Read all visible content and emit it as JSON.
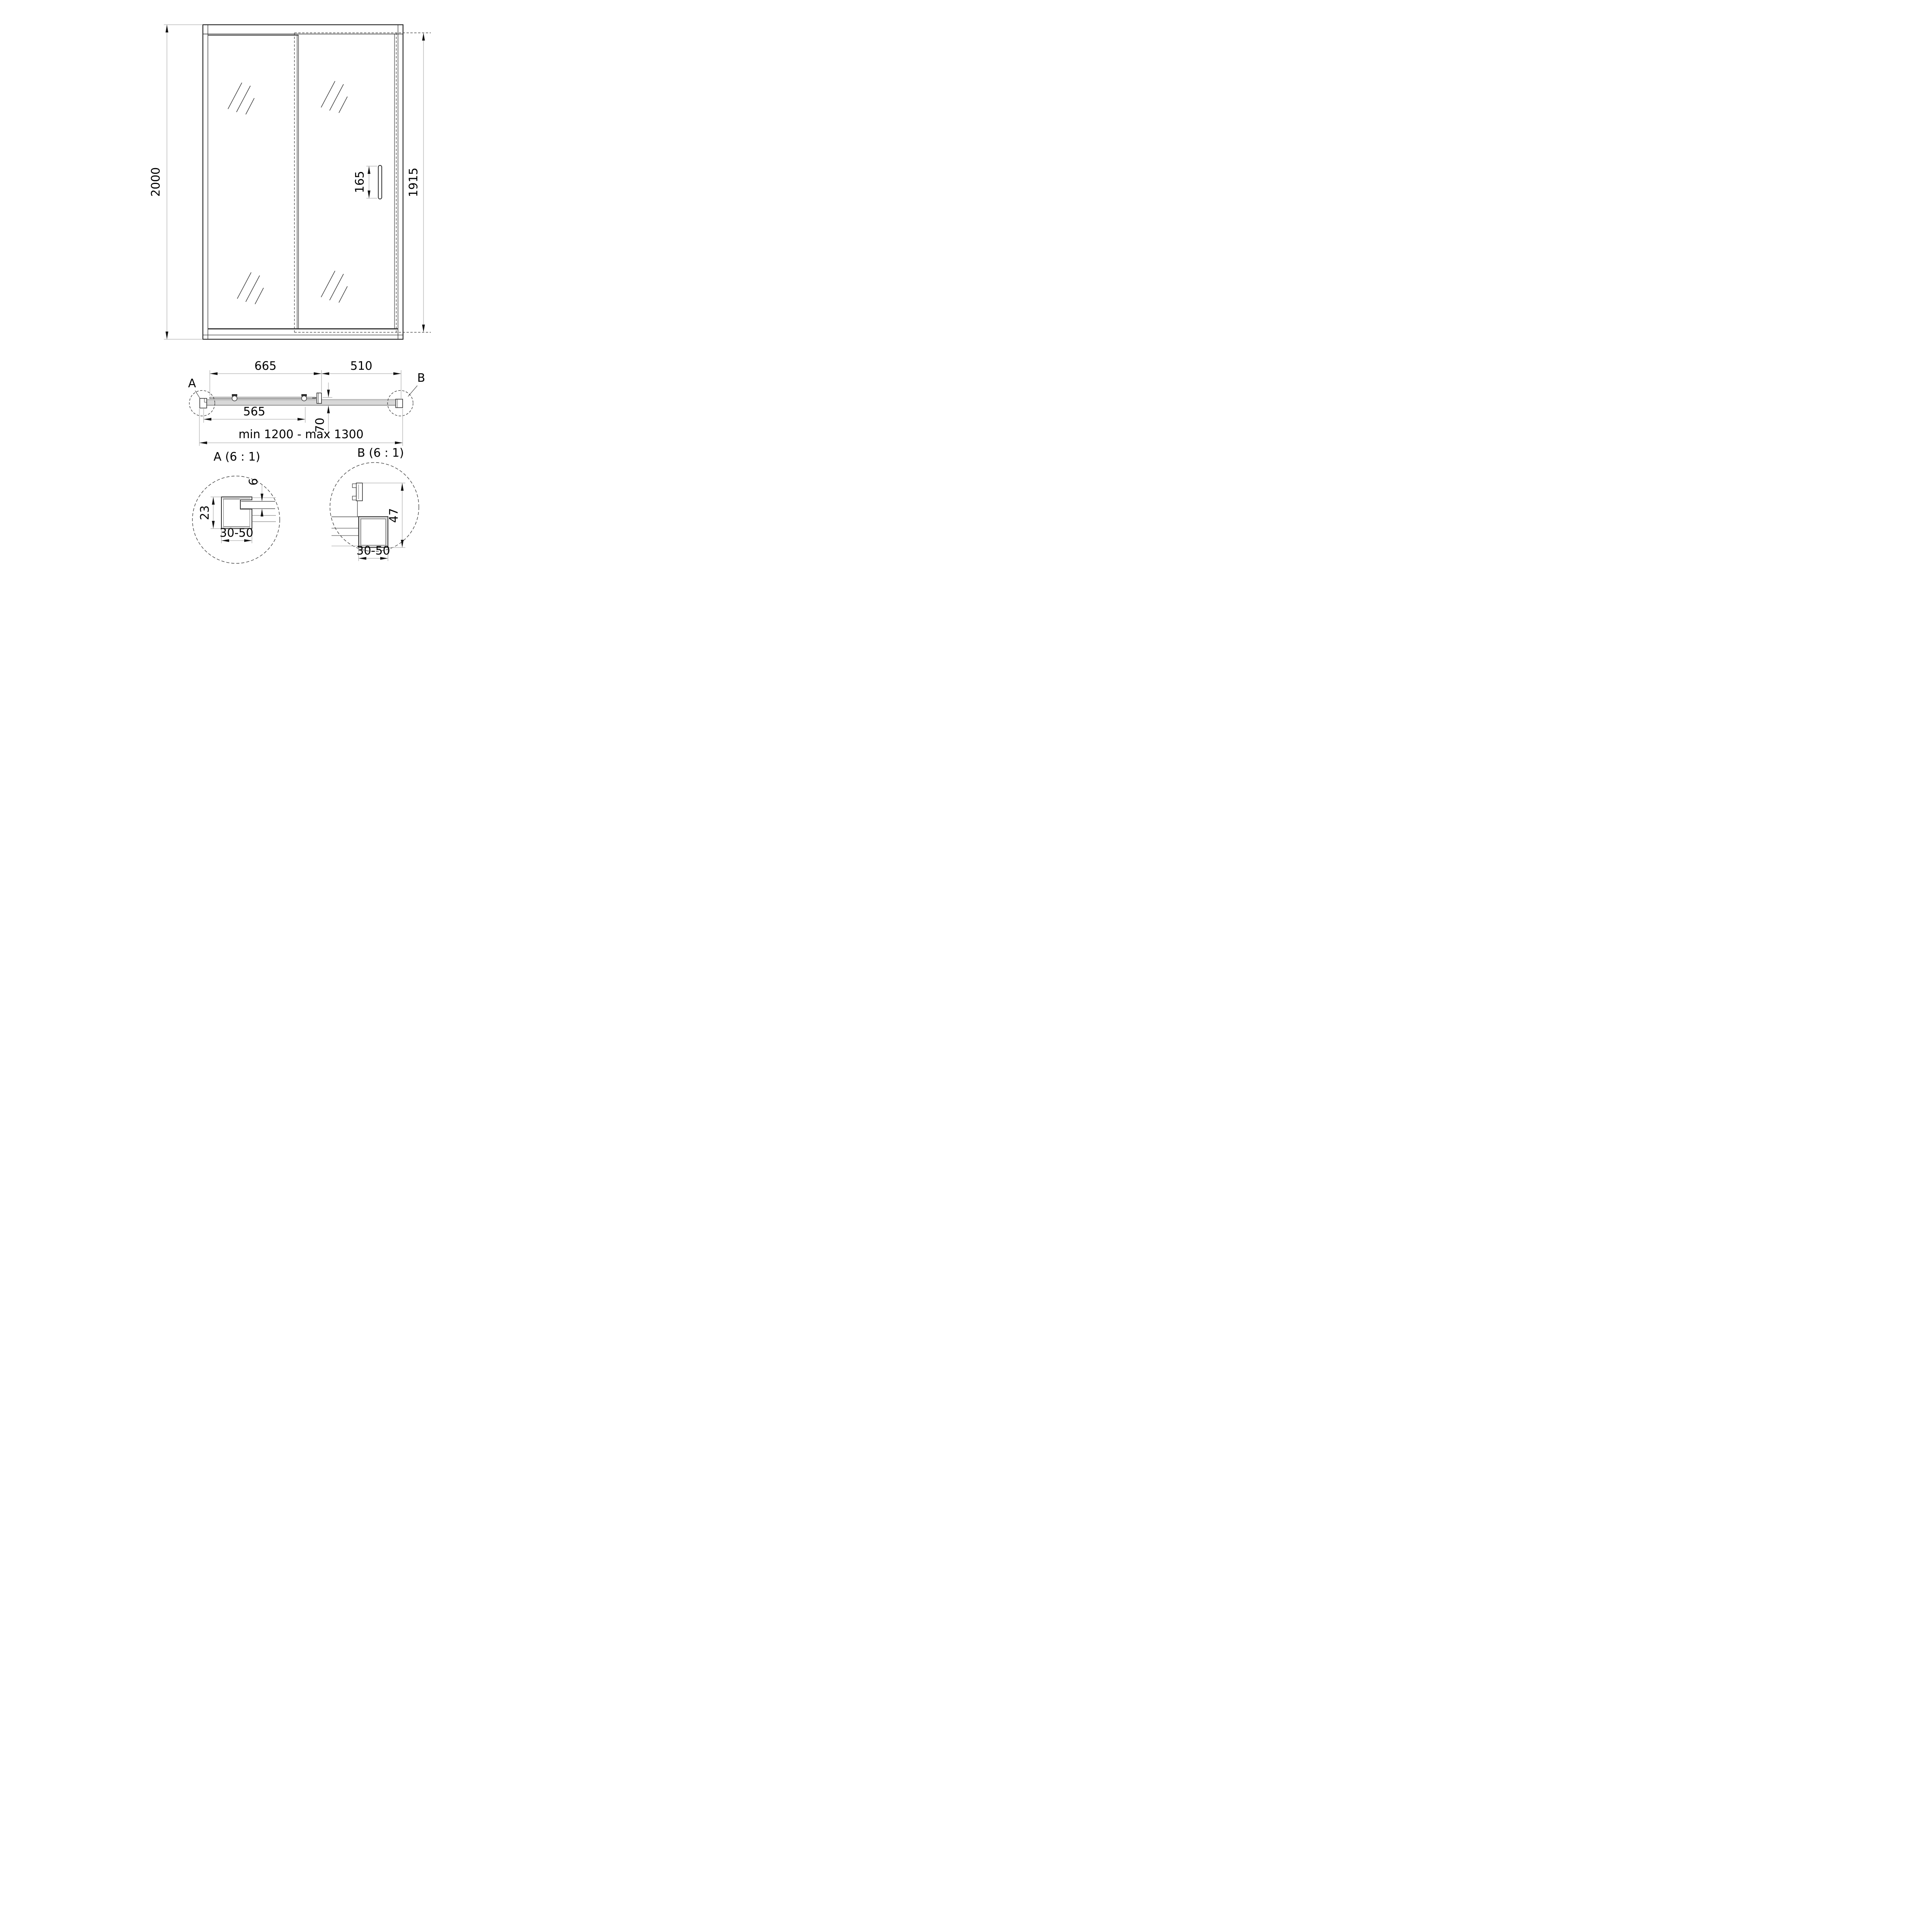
{
  "colors": {
    "line_dark": "#2e2e2e",
    "line_gray": "#9a9a9a",
    "arrow": "#111111",
    "text_color": "#000000",
    "aluminum_fill": "#d8d8d8",
    "aluminum_shade": "#8a8a8a",
    "bg": "#ffffff"
  },
  "views": {
    "front": {
      "dims": {
        "overall_height": "2000",
        "door_glass_height": "1915",
        "handle_length": "165"
      }
    },
    "plan": {
      "dims": {
        "sliding_panel_width": "665",
        "fixed_panel_width": "510",
        "opening_width": "565",
        "panel_offset": "70",
        "width_range": "min 1200 - max 1300"
      },
      "detail_labels": {
        "a": "A",
        "b": "B"
      }
    },
    "detail_a": {
      "title": "A (6 : 1)",
      "dims": {
        "profile_depth": "23",
        "glass_thickness": "6",
        "adjustment_range": "30-50"
      }
    },
    "detail_b": {
      "title": "B (6 : 1)",
      "dims": {
        "profile_height": "47",
        "adjustment_range": "30-50"
      }
    }
  }
}
